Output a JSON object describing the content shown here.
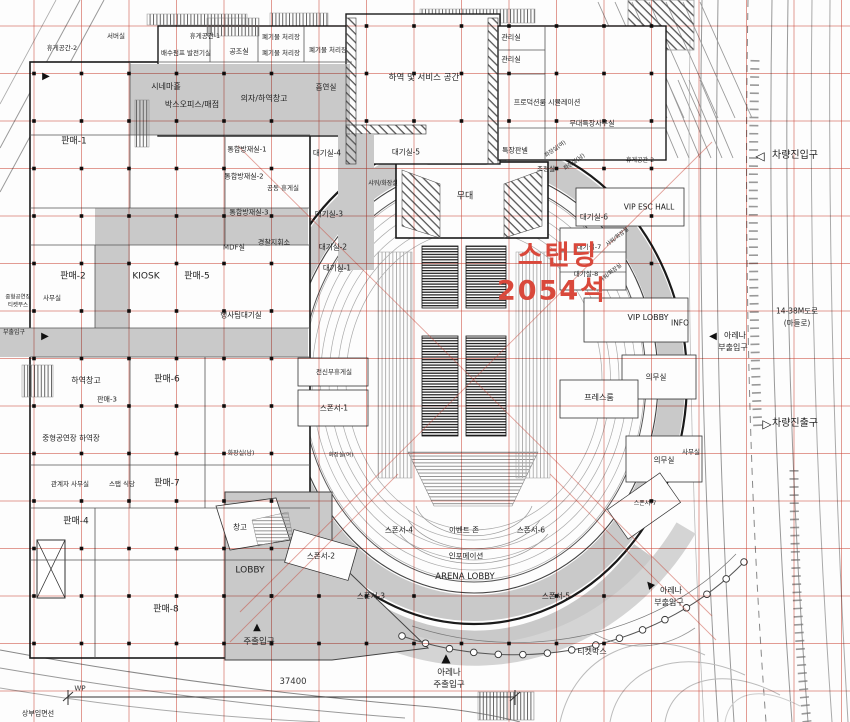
{
  "plan": {
    "colors": {
      "grid": "#cd4b3c",
      "wall": "#1a1a1a",
      "corridor": "#c9c9c9",
      "highlight": "#d9483b"
    },
    "highlight": {
      "line1": "스탠딩",
      "line2": "2054석",
      "seats_text": "2054석",
      "color": "#d9483b"
    },
    "dimension": {
      "label": "WP",
      "value": "37400"
    },
    "labels": [
      {
        "t": "휴게공간-2",
        "x": 62,
        "y": 48,
        "s": 6.5
      },
      {
        "t": "서버실",
        "x": 116,
        "y": 36,
        "s": 6.5
      },
      {
        "t": "휴게공간-1",
        "x": 205,
        "y": 36,
        "s": 6.5
      },
      {
        "t": "배수펌프 발전기실",
        "x": 186,
        "y": 53,
        "s": 6.5
      },
      {
        "t": "공조실",
        "x": 239,
        "y": 52,
        "s": 7
      },
      {
        "t": "폐기물 처리장",
        "x": 281,
        "y": 37,
        "s": 6.5
      },
      {
        "t": "폐기물 처리장",
        "x": 281,
        "y": 53,
        "s": 6.5
      },
      {
        "t": "폐기물 처리장",
        "x": 328,
        "y": 50,
        "s": 6.5
      },
      {
        "t": "시네마홀",
        "x": 166,
        "y": 87,
        "s": 8
      },
      {
        "t": "박스오피스/매점",
        "x": 192,
        "y": 105,
        "s": 8
      },
      {
        "t": "의자/하역창고",
        "x": 264,
        "y": 99,
        "s": 8
      },
      {
        "t": "흡연실",
        "x": 326,
        "y": 87,
        "s": 7.5
      },
      {
        "t": "하역 및 서비스 공간",
        "x": 424,
        "y": 78,
        "s": 8.5
      },
      {
        "t": "관리실",
        "x": 511,
        "y": 38,
        "s": 7
      },
      {
        "t": "관리실",
        "x": 511,
        "y": 60,
        "s": 7
      },
      {
        "t": "프로덕션룸 시뮬레이션",
        "x": 547,
        "y": 103,
        "s": 7
      },
      {
        "t": "무대특장사무실",
        "x": 592,
        "y": 124,
        "s": 7
      },
      {
        "t": "특장판넬",
        "x": 515,
        "y": 151,
        "s": 7
      },
      {
        "t": "조정실",
        "x": 546,
        "y": 169,
        "s": 6.5
      },
      {
        "t": "화장실(여)",
        "x": 556,
        "y": 150,
        "s": 5.5,
        "r": -35
      },
      {
        "t": "화장실(남)",
        "x": 575,
        "y": 163,
        "s": 5.5,
        "r": -35
      },
      {
        "t": "휴게공간-2",
        "x": 640,
        "y": 161,
        "s": 6
      },
      {
        "t": "대기실-4",
        "x": 327,
        "y": 153,
        "s": 7.5
      },
      {
        "t": "대기실-5",
        "x": 406,
        "y": 152,
        "s": 7.5
      },
      {
        "t": "샤워/화장실",
        "x": 383,
        "y": 184,
        "s": 6
      },
      {
        "t": "무대",
        "x": 465,
        "y": 197,
        "s": 9
      },
      {
        "t": "공동 휴게실",
        "x": 283,
        "y": 188,
        "s": 6.5
      },
      {
        "t": "대기실-3",
        "x": 329,
        "y": 214,
        "s": 7.5
      },
      {
        "t": "대기실-2",
        "x": 333,
        "y": 247,
        "s": 7.5
      },
      {
        "t": "대기실-1",
        "x": 337,
        "y": 268,
        "s": 7.5
      },
      {
        "t": "통합방재실-1",
        "x": 247,
        "y": 150,
        "s": 7
      },
      {
        "t": "통합방재실-2",
        "x": 244,
        "y": 177,
        "s": 7
      },
      {
        "t": "통합방재실-3",
        "x": 249,
        "y": 213,
        "s": 7
      },
      {
        "t": "MDF실",
        "x": 234,
        "y": 248,
        "s": 7
      },
      {
        "t": "경찰지휘소",
        "x": 274,
        "y": 243,
        "s": 7
      },
      {
        "t": "행사팀대기실",
        "x": 241,
        "y": 315,
        "s": 7.5
      },
      {
        "t": "사무실",
        "x": 52,
        "y": 298,
        "s": 6.5
      },
      {
        "t": "중형공연장",
        "x": 18,
        "y": 298,
        "s": 5.5
      },
      {
        "t": "티켓부스",
        "x": 18,
        "y": 306,
        "s": 5.5
      },
      {
        "t": "판매-1",
        "x": 74,
        "y": 142,
        "s": 9
      },
      {
        "t": "판매-2",
        "x": 73,
        "y": 277,
        "s": 9
      },
      {
        "t": "KIOSK",
        "x": 146,
        "y": 277,
        "s": 9
      },
      {
        "t": "판매-5",
        "x": 197,
        "y": 277,
        "s": 9
      },
      {
        "t": "대기실-6",
        "x": 594,
        "y": 217,
        "s": 7.5
      },
      {
        "t": "대기실-7",
        "x": 589,
        "y": 247,
        "s": 6.5
      },
      {
        "t": "대기실-8",
        "x": 586,
        "y": 274,
        "s": 6.5
      },
      {
        "t": "VIP ESC HALL",
        "x": 649,
        "y": 207,
        "s": 7.5
      },
      {
        "t": "샤워/화장실",
        "x": 618,
        "y": 238,
        "s": 5.5,
        "r": -38
      },
      {
        "t": "샤워/화장실",
        "x": 611,
        "y": 274,
        "s": 5.5,
        "r": -38
      },
      {
        "t": "VIP LOBBY",
        "x": 648,
        "y": 318,
        "s": 8
      },
      {
        "t": "INFO",
        "x": 680,
        "y": 323,
        "s": 7.5
      },
      {
        "t": "아레나",
        "x": 735,
        "y": 336,
        "s": 8
      },
      {
        "t": "부출입구",
        "x": 733,
        "y": 348,
        "s": 8
      },
      {
        "t": "14-38M도로",
        "x": 797,
        "y": 311,
        "s": 7.5
      },
      {
        "t": "(마들로)",
        "x": 797,
        "y": 323,
        "s": 7.5
      },
      {
        "t": "의무실",
        "x": 656,
        "y": 377,
        "s": 7.5
      },
      {
        "t": "프레스룸",
        "x": 599,
        "y": 398,
        "s": 8
      },
      {
        "t": "차량진출구",
        "x": 795,
        "y": 424,
        "s": 10
      },
      {
        "t": "의무실",
        "x": 664,
        "y": 460,
        "s": 7.5
      },
      {
        "t": "사무실",
        "x": 691,
        "y": 452,
        "s": 6.5
      },
      {
        "t": "전신부휴게실",
        "x": 334,
        "y": 372,
        "s": 6.5
      },
      {
        "t": "스폰서-1",
        "x": 334,
        "y": 408,
        "s": 7.5
      },
      {
        "t": "화장실(여)",
        "x": 341,
        "y": 456,
        "s": 5.5
      },
      {
        "t": "하역창고",
        "x": 86,
        "y": 381,
        "s": 8
      },
      {
        "t": "판매-6",
        "x": 167,
        "y": 380,
        "s": 9
      },
      {
        "t": "판매-3",
        "x": 107,
        "y": 400,
        "s": 7
      },
      {
        "t": "중형공연장 하역장",
        "x": 71,
        "y": 438,
        "s": 7.5
      },
      {
        "t": "관계자 사무실",
        "x": 70,
        "y": 484,
        "s": 6.5
      },
      {
        "t": "스탭 식당",
        "x": 122,
        "y": 484,
        "s": 6.5
      },
      {
        "t": "판매-7",
        "x": 167,
        "y": 484,
        "s": 9
      },
      {
        "t": "화장실(남)",
        "x": 241,
        "y": 454,
        "s": 6
      },
      {
        "t": "판매-4",
        "x": 76,
        "y": 522,
        "s": 9
      },
      {
        "t": "창고",
        "x": 240,
        "y": 527,
        "s": 7.5
      },
      {
        "t": "LOBBY",
        "x": 250,
        "y": 571,
        "s": 9
      },
      {
        "t": "판매-8",
        "x": 166,
        "y": 610,
        "s": 9
      },
      {
        "t": "주출입구",
        "x": 259,
        "y": 642,
        "s": 8.5
      },
      {
        "t": "상부입면선",
        "x": 38,
        "y": 714,
        "s": 7
      },
      {
        "t": "스폰서-2",
        "x": 321,
        "y": 556,
        "s": 7.5
      },
      {
        "t": "스폰서-3",
        "x": 371,
        "y": 596,
        "s": 7.5
      },
      {
        "t": "스폰서-4",
        "x": 399,
        "y": 530,
        "s": 7.5
      },
      {
        "t": "이벤트 존",
        "x": 464,
        "y": 530,
        "s": 7.5
      },
      {
        "t": "스폰서-6",
        "x": 531,
        "y": 530,
        "s": 7.5
      },
      {
        "t": "인포메이션",
        "x": 466,
        "y": 556,
        "s": 7.5
      },
      {
        "t": "ARENA LOBBY",
        "x": 465,
        "y": 577,
        "s": 8.5
      },
      {
        "t": "스폰서-5",
        "x": 556,
        "y": 596,
        "s": 7.5
      },
      {
        "t": "스폰서-7",
        "x": 645,
        "y": 504,
        "s": 6
      },
      {
        "t": "아레나",
        "x": 449,
        "y": 673,
        "s": 8.5
      },
      {
        "t": "주출입구",
        "x": 449,
        "y": 685,
        "s": 8.5
      },
      {
        "t": "티켓박스",
        "x": 592,
        "y": 652,
        "s": 8
      },
      {
        "t": "아레나",
        "x": 671,
        "y": 591,
        "s": 8
      },
      {
        "t": "부출입구",
        "x": 669,
        "y": 603,
        "s": 8
      },
      {
        "t": "차량진입구",
        "x": 795,
        "y": 156,
        "s": 10
      },
      {
        "t": "부출입구",
        "x": 14,
        "y": 333,
        "s": 6
      }
    ],
    "arrows": [
      {
        "g": "◁",
        "x": 760,
        "y": 156,
        "s": 12,
        "name": "vehicle-entry-arrow"
      },
      {
        "g": "▷",
        "x": 767,
        "y": 424,
        "s": 12,
        "name": "vehicle-exit-arrow"
      },
      {
        "g": "▶",
        "x": 46,
        "y": 77,
        "s": 10,
        "name": "side-entrance-arrow"
      },
      {
        "g": "▶",
        "x": 45,
        "y": 337,
        "s": 10,
        "name": "side-entrance-arrow"
      },
      {
        "g": "▲",
        "x": 257,
        "y": 628,
        "s": 10,
        "name": "main-entrance-arrow"
      },
      {
        "g": "▲",
        "x": 446,
        "y": 658,
        "s": 12,
        "name": "arena-main-entrance-arrow"
      },
      {
        "g": "◀",
        "x": 713,
        "y": 337,
        "s": 10,
        "name": "arena-side-entrance-arrow"
      },
      {
        "g": "▲",
        "x": 650,
        "y": 585,
        "s": 10,
        "r": -40,
        "name": "arena-side-entrance-arrow"
      }
    ]
  }
}
